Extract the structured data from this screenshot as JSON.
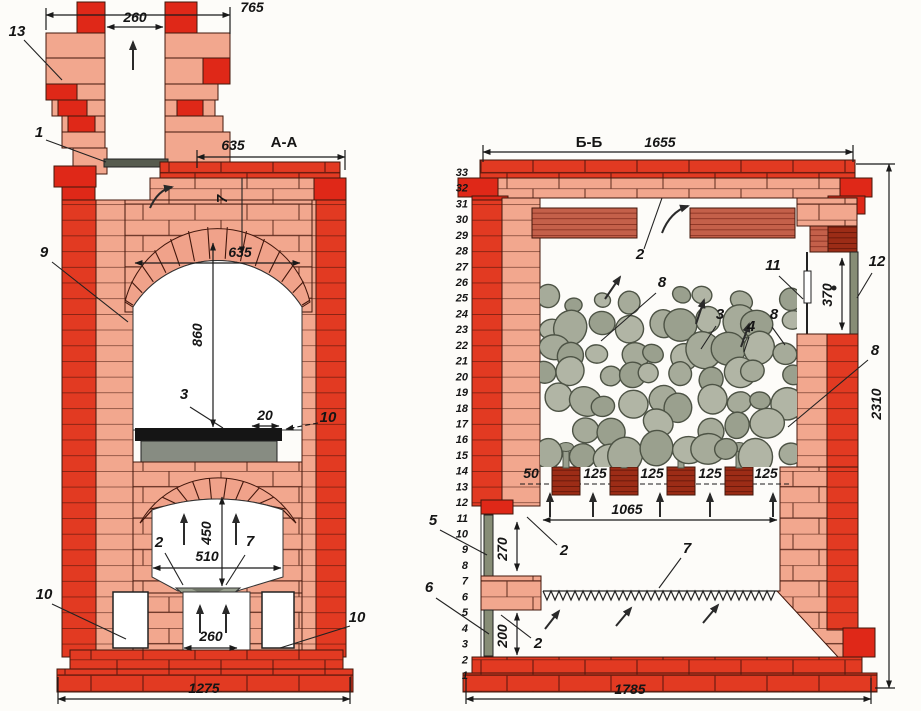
{
  "section_a": {
    "title": "А-А",
    "dims": {
      "chimney_top": "765",
      "flue_width": "260",
      "top_width": "635",
      "oven_width": "635",
      "oven_height": "860",
      "slab_overhang": "20",
      "firebox_height": "450",
      "firebox_width": "510",
      "outlet_width": "260",
      "base_width": "1275"
    },
    "parts": {
      "p13": "13",
      "p1": "1",
      "p9": "9",
      "p7_top": "7",
      "p3": "3",
      "p10_right": "10",
      "p2": "2",
      "p7": "7",
      "p10_left": "10",
      "p10_bottom_right": "10"
    }
  },
  "section_b": {
    "title": "Б-Б",
    "dims": {
      "top_width": "1655",
      "total_height": "2310",
      "door_channel": "370",
      "stone_gap": "50",
      "rail_pitch": "125",
      "rail_span": "1065",
      "mid_height": "270",
      "ash_height": "200",
      "base_width": "1785"
    },
    "parts": {
      "p2_top": "2",
      "p11": "11",
      "p12": "12",
      "p8_left": "8",
      "p3": "3",
      "p4": "4",
      "p8_mid": "8",
      "p8_right": "8",
      "p2_mid": "2",
      "p7": "7",
      "p2_bottom": "2",
      "p5": "5",
      "p6": "6"
    },
    "rows": [
      "1",
      "2",
      "3",
      "4",
      "5",
      "6",
      "7",
      "8",
      "9",
      "10",
      "11",
      "12",
      "13",
      "14",
      "15",
      "16",
      "17",
      "18",
      "19",
      "20",
      "21",
      "22",
      "23",
      "24",
      "25",
      "26",
      "27",
      "28",
      "29",
      "30",
      "31",
      "32",
      "33"
    ]
  },
  "colors": {
    "brick_red": "#e23a22",
    "brick_pink": "#f2a78e",
    "brick_dark": "#9c2c16",
    "joint": "#6e1d10",
    "stone": "#a6ab9a",
    "metal": "#878d76",
    "line": "#1a1a1a"
  }
}
